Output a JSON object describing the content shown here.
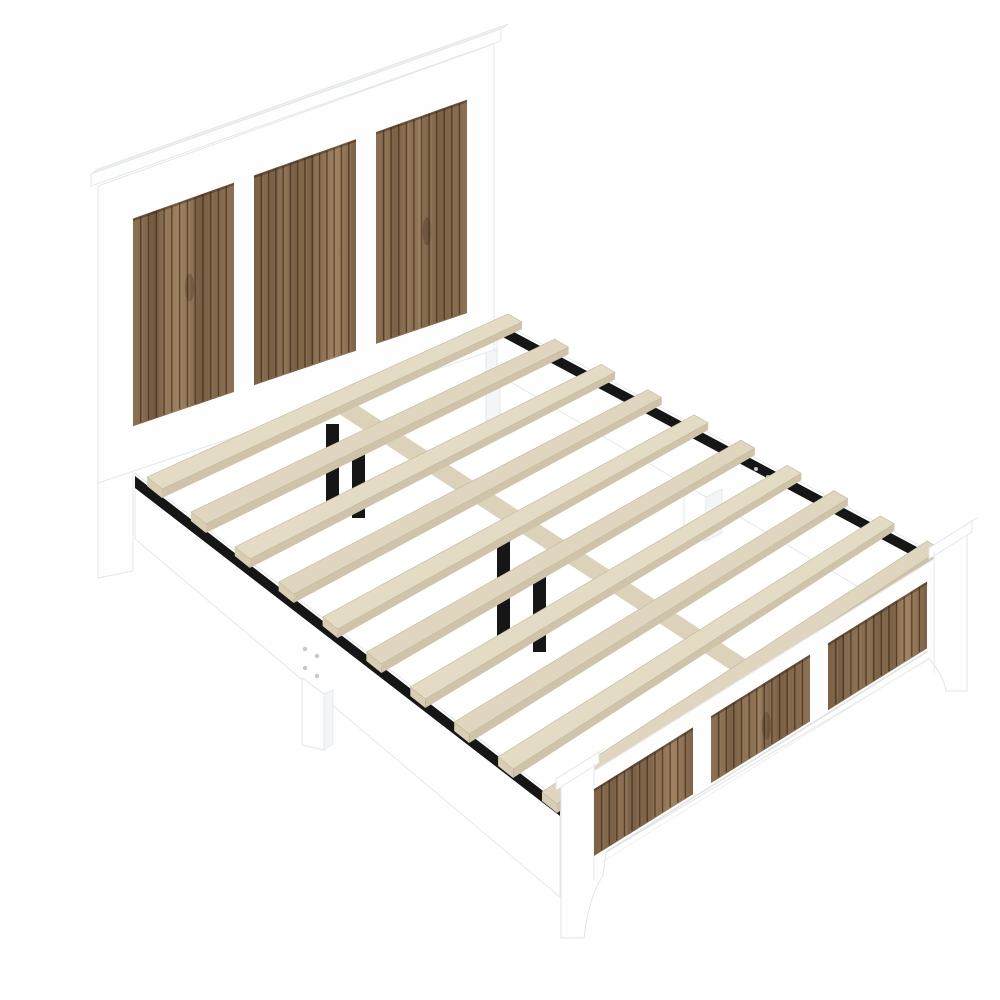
{
  "scene": {
    "subject": "platform-bed-frame",
    "view": "three-quarter-top"
  },
  "colors": {
    "background": "#ffffff",
    "frame_white": "#fefefe",
    "frame_shade": "#f3f5f6",
    "frame_edge": "#e2e5e7",
    "cap_top": "#eef1f2",
    "wood_base_1": "#8d7154",
    "wood_base_2": "#7d6145",
    "wood_light": "#a08363",
    "wood_dark": "#4f3b27",
    "knot": "#3a2b1b",
    "groove": "#342718",
    "groove_shadow": "#201710",
    "slat_top": "#e4dbc4",
    "slat_top_alt": "#e0d6bf",
    "slat_front": "#cfc4a9",
    "slat_end": "#d9ceb4",
    "center_rail_top": "#dcd2ba",
    "center_rail_front": "#c3b89c",
    "metal": "#161616",
    "screw": "#c6c9cb"
  },
  "counts": {
    "headboard_panels": 3,
    "footboard_panels": 3,
    "slats": 10,
    "center_support_legs": 4,
    "side_rails": 2,
    "screw_sets": 2,
    "screws_per_set": 4
  },
  "wood": {
    "groove_spacing": 7.5
  }
}
